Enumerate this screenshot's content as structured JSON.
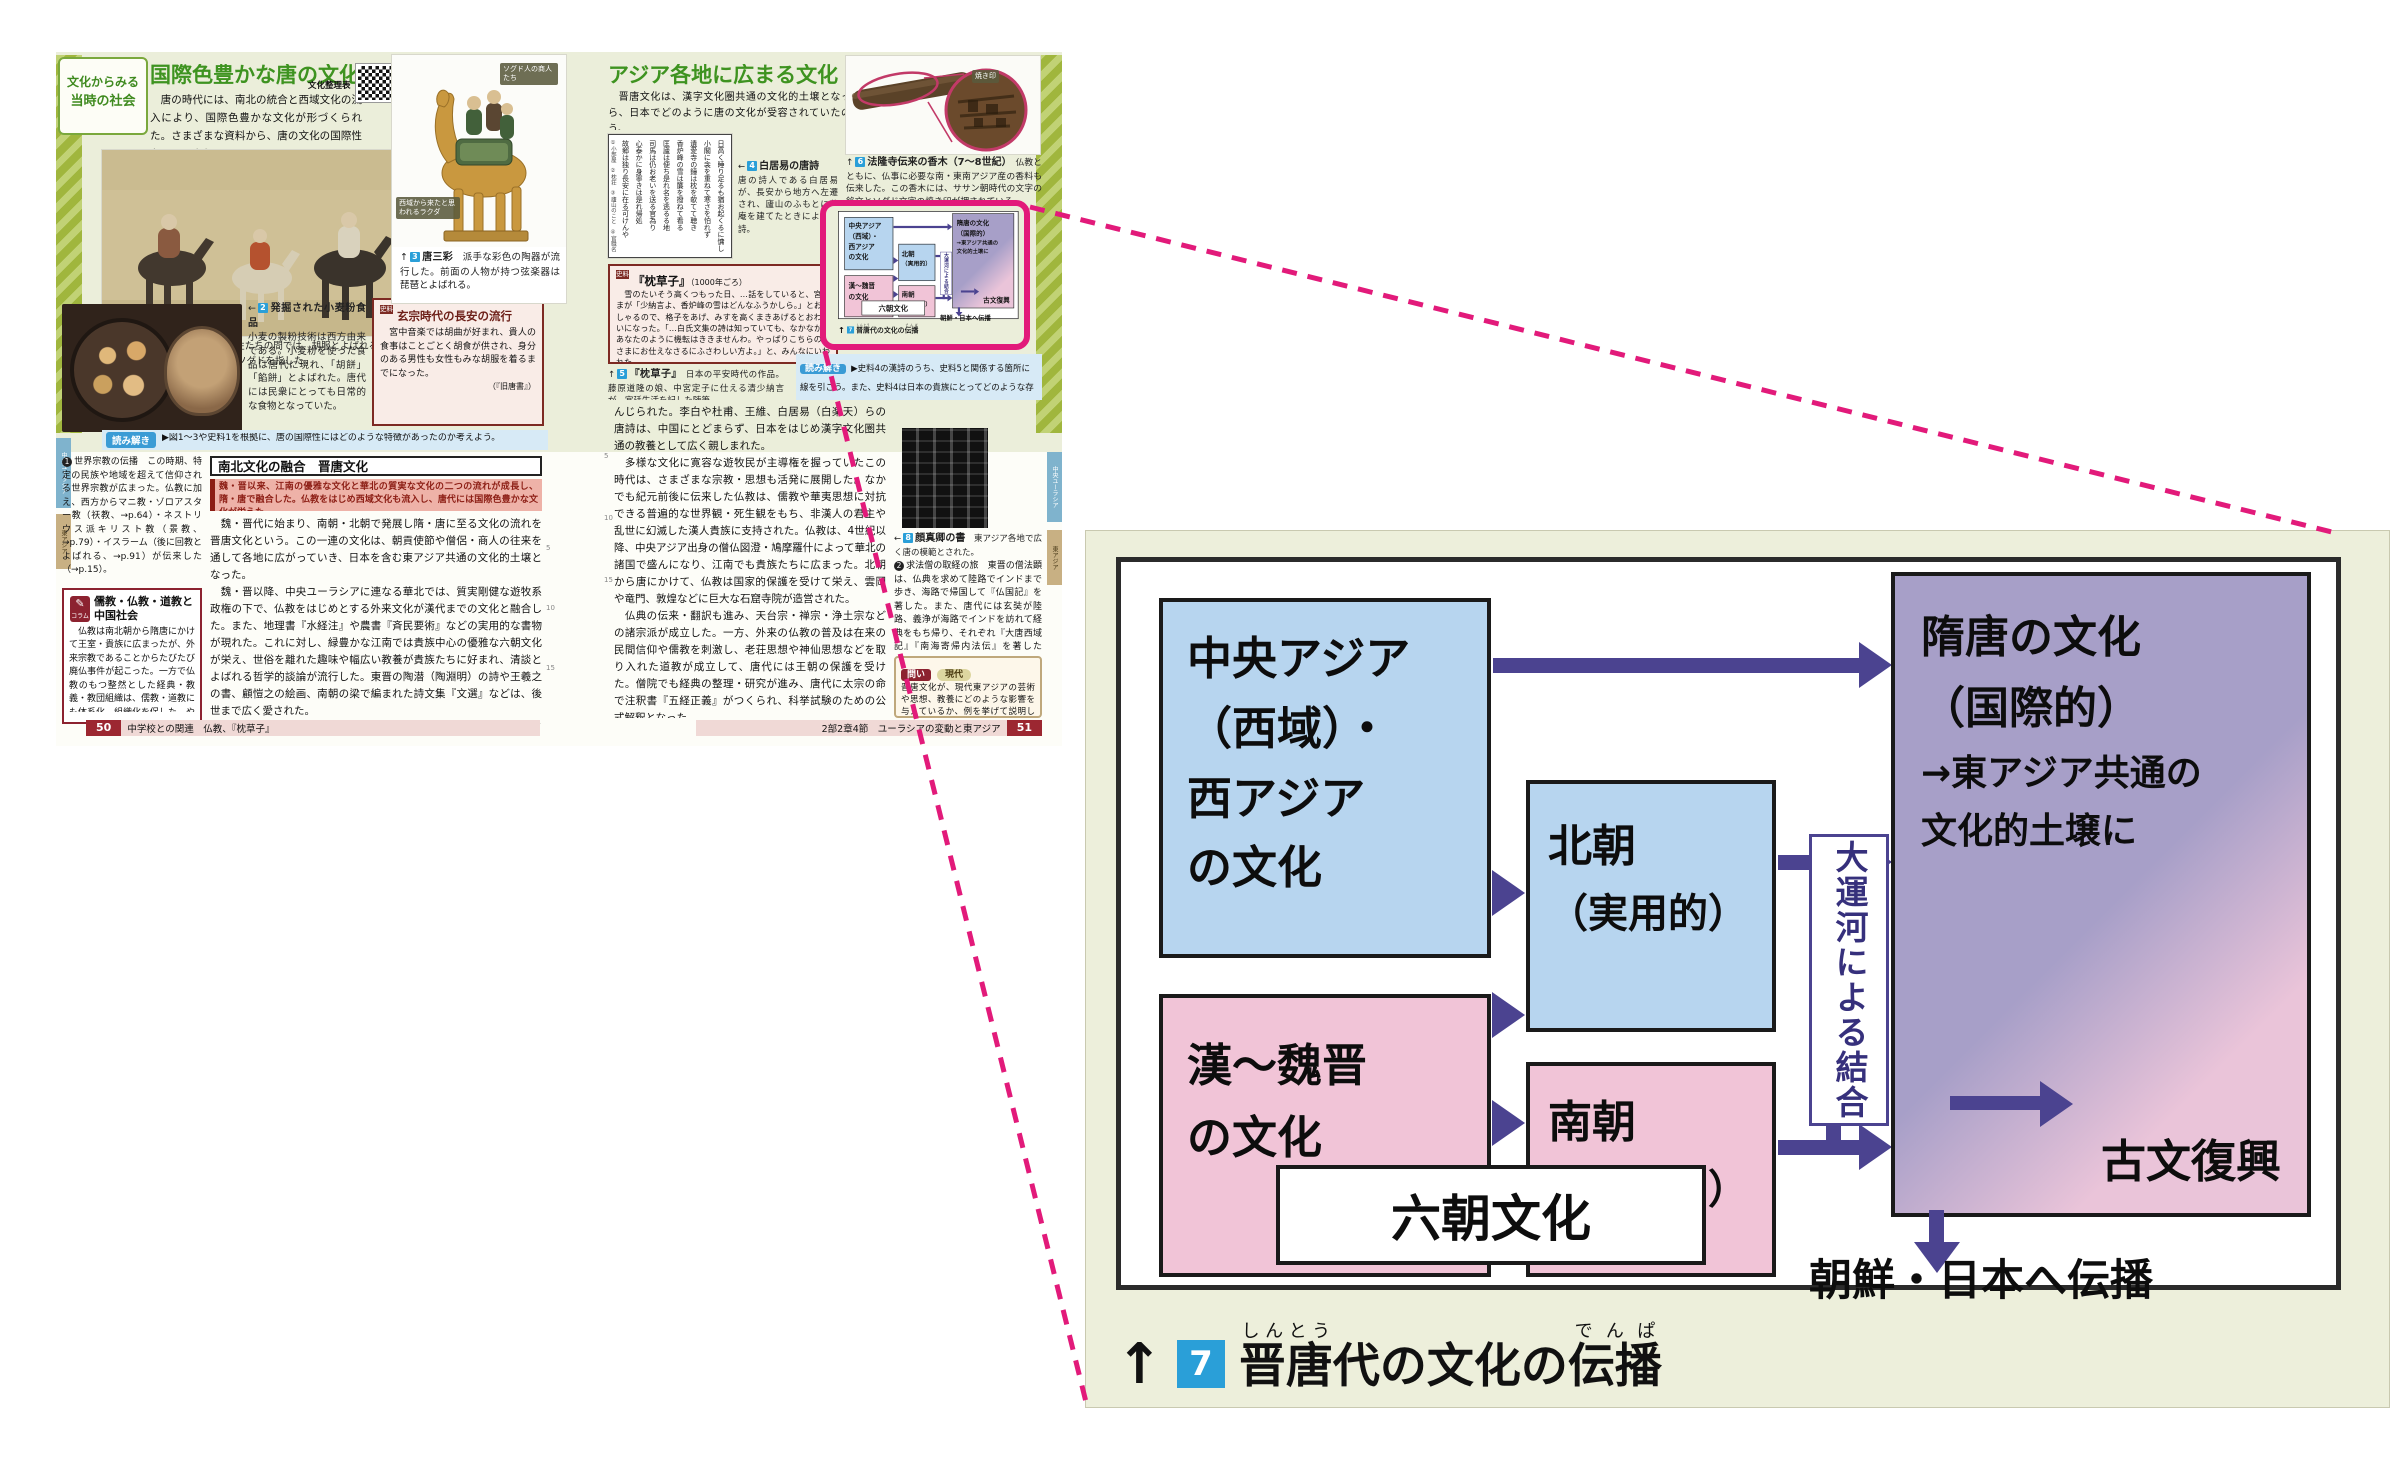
{
  "colors": {
    "highlight_pink": "#e21a7a",
    "arrow_indigo": "#4b4390",
    "box_blue": "#b7d5ef",
    "box_pink": "#f1c4d7",
    "box_purple": "#a79fc8",
    "panel_beige": "#edefdb",
    "title_green": "#3e9320",
    "dark_red": "#8c2230",
    "badge_blue": "#2a9fd8"
  },
  "d": {
    "central": {
      "l1": "中央アジア",
      "l2": "（西域）・",
      "l3": "西アジア",
      "l4": "の文化"
    },
    "han": {
      "l1": "漢～魏晋",
      "l2": "の文化"
    },
    "north": {
      "l1": "北朝",
      "l2": "（実用的）"
    },
    "south": {
      "l1": "南朝",
      "l2": "（貴族的）"
    },
    "six": "六朝文化",
    "canal": "大運河による結合",
    "sui": {
      "l1": "隋唐の文化",
      "l2": "（国際的）",
      "l3": "→東アジア共通の",
      "l4": "文化的土壌に"
    },
    "kobun": "古文復興",
    "spread": "朝鮮・日本へ伝播",
    "cap": {
      "arrow": "↑",
      "num": "7",
      "p1": "晋唐",
      "r1": "しんとう",
      "p2": "代の文化の",
      "p3": "伝播",
      "r2": "でんぱ"
    },
    "relations": "中央アジア（西域）・西アジアの文化→隋唐の文化／中央アジア・西アジアの文化→北朝／漢～魏晋の文化→北朝／漢～魏晋の文化→南朝／北朝＋南朝＝大運河による結合→隋唐の文化／隋唐の文化→古文復興／隋唐の文化→朝鮮・日本へ伝播／北朝＋南朝＝六朝文化"
  },
  "p50": {
    "tab1": "文化からみる",
    "tab2": "当時の社会",
    "title": "国際色豊かな唐の文化",
    "intro": "　唐の時代には、南北の統合と西域文化の流入により、国際色豊かな文化が形づくられた。さまざまな資料から、唐の文化の国際性をみてみよう。",
    "qr": "文化整理表",
    "edge1": "中央ユーラシア",
    "edge2": "東アジア",
    "cap1_dir": "↑",
    "cap1_n": "1",
    "cap1_t": "外出する宮廷の人々",
    "cap1_x": "女性たちの間では、胡服とよばれる、筒袖で体にぴったり沿う西方趣味の服装が流行した。胡とは、当時ソグドを指した。",
    "badge_sogd": "ソグド人の商人たち",
    "badge_camel": "西域から来たと思われるラクダ",
    "cap3_dir": "↑",
    "cap3_n": "3",
    "cap3_t": "唐三彩",
    "cap3_x": "派手な彩色の陶器が流行した。前面の人物が持つ弦楽器は琵琶とよばれる。",
    "cap2_dir": "←",
    "cap2_n": "2",
    "cap2_t": "発掘された小麦粉食品",
    "cap2_x": "小麦の製粉技術は西方由来である。小麦粉を使った食品は唐代に現れ、「胡餅」「餡餅」とよばれた。唐代には民衆にとっても日常的な食物となっていた。",
    "s1_b": "史料",
    "s1_t": "玄宗時代の長安の流行",
    "s1_x": "　宮中音楽では胡曲が好まれ、貴人の食事はことごとく胡食が供され、身分のある男性も女性もみな胡服を着るまでになった。",
    "s1_src": "（『旧唐書』）",
    "yomi_l": "読み解き",
    "yomi_x": "▶図1～3や史料1を根拠に、唐の国際性にはどのような特徴があったのか考えよう。",
    "head": "南北文化の融合　晋唐文化",
    "summary": "魏・晋以来、江南の優雅な文化と華北の質実な文化の二つの流れが成長し、隋・唐で融合した。仏教をはじめ西域文化も流入し、唐代には国際色豊かな文化が栄えた。",
    "body1": "　魏・晋代に始まり、南朝・北朝で発展し隋・唐に至る文化の流れを晋唐文化という。この一連の文化は、朝貢使節や僧侶・商人の往来を通して各地に広がっていき、日本を含む東アジア共通の文化的土壌となった。",
    "body2": "　魏・晋以降、中央ユーラシアに連なる華北では、質実剛健な遊牧系政権の下で、仏教をはじめとする外来文化が漢代までの文化と融合した。また、地理書『水経注』や農書『斉民要術』などの実用的な書物が現れた。これに対し、緑豊かな江南では貴族中心の優雅な六朝文化が栄え、世俗を離れた趣味や幅広い教養が貴族たちに好まれ、清談とよばれる哲学的談論が流行した。東晋の陶潜（陶淵明）の詩や王羲之の書、顧愷之の絵画、南朝の梁で編まれた詩文集『文選』などは、後世まで広く愛された。",
    "body3": "　この二つの流れが南北の統合と大運河によって結びつき、さらにソグド文化やインド系・イラン系文化などの入り混じった西域文化が流入・融合したのが、隋唐の文化である。主に華北で発展した漢訳仏教や仏像、江南で発達した詩文や書・画は、遊牧民と漢人、華北と江南といった違いを超えて広く受け入れられ、さらに時代や地域をも超えて後世まで重",
    "n1_num": "1",
    "note1": "世界宗教の伝播　この時期、特定の民族や地域を超えて信仰される世界宗教が広まった。仏教に加え、西方からマニ教・ゾロアスター教（祆教、→p.64）・ネストリウス派キリスト教（景教、→p.79）・イスラーム（後に回教とよばれる、→p.91）が伝来した（→p.15）。",
    "col_b": "コラム",
    "col_t": "儒教・仏教・道教と中国社会",
    "col_x": "　仏教は南北朝から隋唐にかけて王室・貴族に広まったが、外来宗教であることからたびたび廃仏事件が起こった。一方で仏教のもつ整然とした経典・教義・教団組織は、儒教・道教にも体系化、組織化を促した。やがて中国社会では、儒教を公認の政治思想としつつ、道教を信じ仏教も学ぶというあり方が定着していった。",
    "foot_p": "50",
    "foot_x": "中学校との関連　仏教、『枕草子』",
    "ln5": "5",
    "ln10": "10",
    "ln15": "15"
  },
  "p51": {
    "title": "アジア各地に広まる文化",
    "intro": "　晋唐文化は、漢字文化圏共通の文化的土壌となった。資料から、日本でどのように唐の文化が受容されていたのかみてみよう。",
    "poem": {
      "l1": "日高く睡り足るも猶お起くるに慵し",
      "l2": "小閣に衾を重ねて寒さを怕れず",
      "l3": "遺愛寺の鐘は枕を欹てて聴き",
      "l4": "香炉峰の雪は簾を撥ねて看る",
      "l5": "匡廬は便ち是れ名を逃るる地",
      "l6": "司馬は仍お老いを送る官為り",
      "l7": "心泰かに身寧きは是れ帰処",
      "l8": "故郷は独り長安に在る可けんや",
      "notes": "①小部屋　②枕荘　③廬山のこと　④官職名",
      "src": "〔川合康三訳注『白居易詩選（上）』〕"
    },
    "cap4_dir": "←",
    "cap4_n": "4",
    "cap4_t": "白居易の唐詩",
    "cap4_x": "唐の詩人である白居易が、長安から地方へ左遷され、廬山のふもとに草庵を建てたときによんだ詩。",
    "s2_b": "史料",
    "s2_t": "『枕草子』",
    "s2_d": "（1000年ごろ）",
    "s2_x": "　雪のたいそう高くつもった日、…話をしていると、宮さまが「少納言よ、香炉峰の雪はどんなふうかしら。」とおっしゃるので、格子をあげ、みすを高くまきあげるとおわらいになった。「…白氏文集の詩は知っていても、なかなか、あなたのように機転はききませんわ。やっぱりこちらの宮さまにお仕えなさるにふさわしい方よ。」と、みんなにいわれた。",
    "s2_src": "（大庭みな子訳『現代語訳 枕草子』一部改変）",
    "cap5_dir": "↑",
    "cap5_n": "5",
    "cap5_t": "『枕草子』",
    "cap5_x": "日本の平安時代の作品。藤原道隆の娘、中宮定子に仕える清少納言が、宮廷生活を記した随筆。",
    "cap6_dir": "↑",
    "cap6_n": "6",
    "cap6_t": "法隆寺伝来の香木（7～8世紀）",
    "cap6_x": "仏教とともに、仏事に必要な南・東南アジア産の香料も伝来した。この香木には、ササン朝時代の文字の銘文とソグド文字の焼き印が押されている。",
    "wood_badge": "焼き印",
    "yomi_l": "読み解き",
    "yomi_x": "▶史料4の漢詩のうち、史料5と関係する箇所に線を引こう。また、史料4は日本の貴族にとってどのような存在だったのか考えよう。",
    "body1": "んじられた。李白や杜甫、王維、白居易（白楽天）らの唐詩は、中国にとどまらず、日本をはじめ漢字文化圏共通の教養として広く親しまれた。",
    "body2": "　多様な文化に寛容な遊牧民が主導権を握っていたこの時代は、さまざまな宗教・思想も活発に展開した。なかでも紀元前後に伝来した仏教は、儒教や華夷思想に対抗できる普遍的な世界観・死生観をもち、非漢人の君主や乱世に幻滅した漢人貴族に支持された。仏教は、4世紀以降、中央アジア出身の僧仏図澄・鳩摩羅什によって華北の諸国で盛んになり、江南でも貴族たちに広まった。北朝から唐にかけて、仏教は国家的保護を受けて栄え、雲岡や竜門、敦煌などに巨大な石窟寺院が造営された。",
    "body3": "　仏典の伝来・翻訳も進み、天台宗・禅宗・浄土宗などの諸宗派が成立した。一方、外来の仏教の普及は在来の民間信仰や儒教を刺激し、老荘思想や神仙思想などを取り入れた道教が成立して、唐代には王朝の保護を受けた。僧院でも経典の整理・研究が進み、唐代に太宗の命で注釈書『五経正義』がつくられ、科挙試験のための公式解釈となった。",
    "body4": "　やがて唐代後半になると、このような国際色豊かで普遍性の高い文化から、古文の復興を主張した韓愈・柳宗元らのように、中国内地の風土に根ざし、漢代に模範を求める動きが盛んになった。",
    "cap8_dir": "←",
    "cap8_n": "8",
    "cap8_t": "顔真卿の書",
    "cap8_x": "東アジア各地で広く唐の模範とされた。",
    "n2_num": "2",
    "note2": "求法僧の取経の旅　東晋の僧法顕は、仏典を求めて陸路でインドまで歩き、海路で帰国して『仏国記』を著した。また、唐代には玄奘が陸路、義浄が海路でインドを訪れて経典をもち帰り、それぞれ『大唐西域記』『南海寄帰内法伝』を著した（→p.48）。",
    "toi_l": "問い",
    "toi_tag": "現代",
    "toi_x": "晋唐文化が、現代東アジアの芸術や思想、教養にどのような影響を与えているか、例を挙げて説明しよう。",
    "foot_x": "2部2章4節　ユーラシアの変動と東アジア",
    "foot_p": "51"
  }
}
